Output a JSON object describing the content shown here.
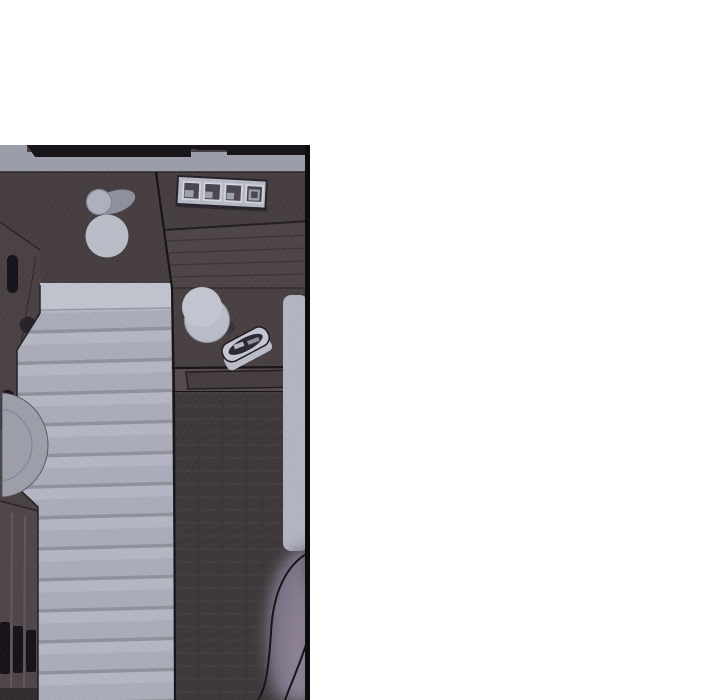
{
  "scene": {
    "kind": "webtoon comic panel, top-down view of a dim room",
    "page_background": "#ffffff"
  },
  "colors": {
    "page_bg": "#ffffff",
    "panel_border": "#0d0b0f",
    "top_wall_black": "#17141a",
    "ledge_gray": "#9b9da9",
    "wall_wood": "#463e41",
    "hutch_wood": "#4e4547",
    "desk_wood": "#484042",
    "desk_front": "#554b4e",
    "drawer_inset": "#463d40",
    "floor_dark": "#3f383b",
    "wardrobe_wood": "#4a4143",
    "drawer_wood": "#4f4649",
    "handle_black": "#16131a",
    "bed_base": "#aaacba",
    "bed_stripe_line": "#8f929a",
    "bed_stripe_light": "#b4b6c4",
    "bed_top_bright": "#c1c4ce",
    "mat_gray": "#b2b5c0",
    "cushion_gray": "#9c9eaa",
    "porcelain": "#babdc8",
    "porcelain_bright": "#c2c5d0",
    "porcelain_shadow": "#8e909c",
    "window_frame": "#b7bac4",
    "window_pane": "#4b4650",
    "pane_glint": "#9ea1ab",
    "dish_light": "#c4c7d2",
    "dish_dark": "#2e2930",
    "blur_figure": "#80768a",
    "blur_figure_light": "#8d8296",
    "outline_dark": "#17131a"
  },
  "objects": {
    "window_unit": "four-pane window frame on upper wall",
    "vase": "round vase with cast shadow",
    "cup": "cup on desk",
    "dish": "small tray on desk",
    "bed": "striped mattress / futon",
    "wardrobe": "wardrobe along left wall",
    "drawers": "drawer unit bottom left",
    "cushion": "round floor cushion",
    "side_mat": "gray mat along right edge",
    "foreground_figure": "blurred foreground shape bottom right"
  }
}
